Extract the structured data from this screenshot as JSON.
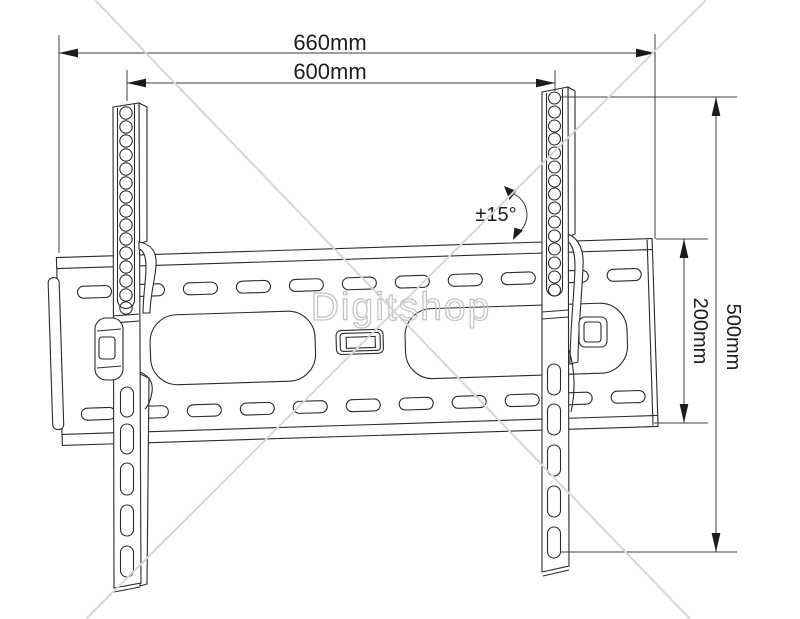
{
  "drawing": {
    "subject": "tilting-tv-wall-mount-technical-drawing",
    "line_color": "#2b2b2b",
    "dimension_color": "#3f3f3f",
    "background": "#ffffff"
  },
  "dimensions": {
    "outer_width": "660mm",
    "vesa_width": "600mm",
    "outer_height": "500mm",
    "plate_height": "200mm",
    "tilt_range": "±15°"
  },
  "watermark": {
    "text": "Digitshop",
    "text_color": "#c5c5c5",
    "line_color": "#d7d7d7"
  }
}
